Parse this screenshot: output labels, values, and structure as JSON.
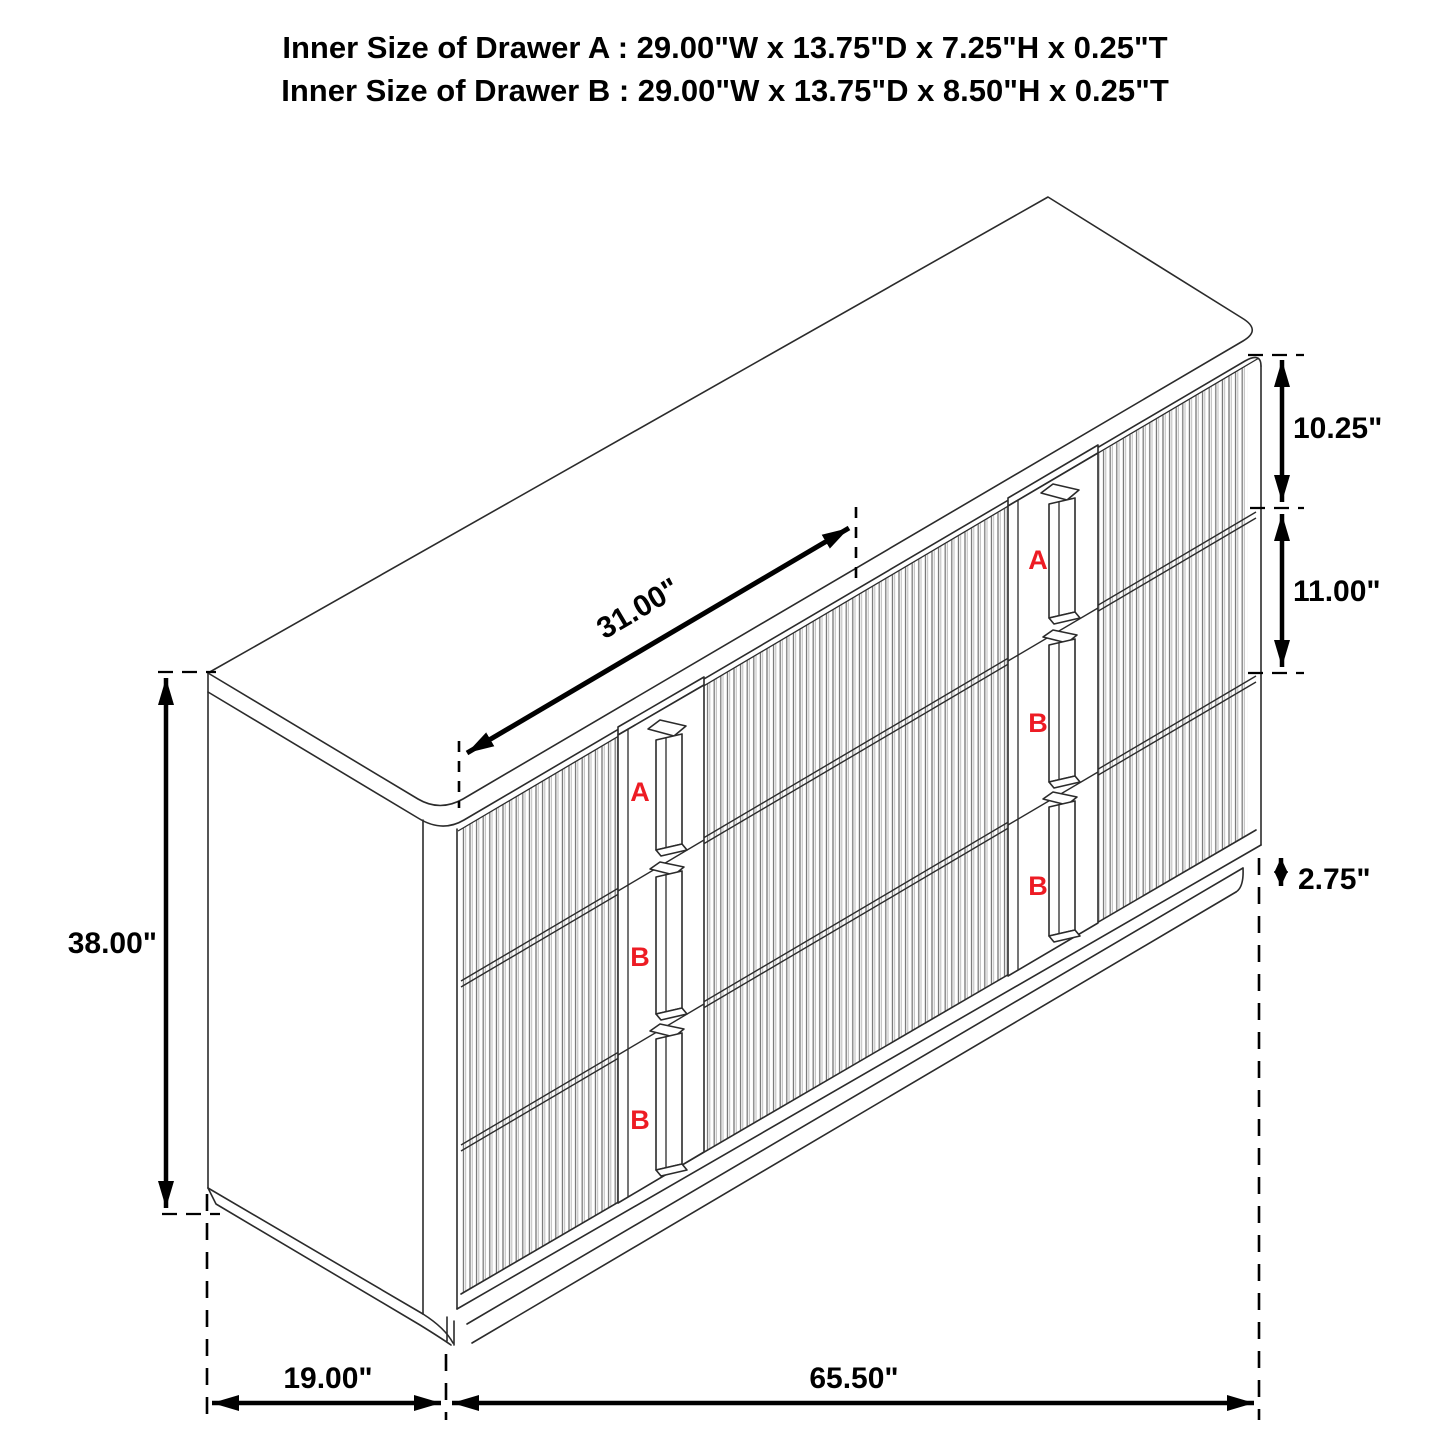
{
  "title": {
    "line1": "Inner Size of Drawer A : 29.00\"W x 13.75\"D x 7.25\"H x 0.25\"T",
    "line2": "Inner Size of Drawer B : 29.00\"W x 13.75\"D x 8.50\"H x 0.25\"T"
  },
  "dimensions": {
    "drawer_a_front_height": "10.25\"",
    "drawer_b_front_height": "11.00\"",
    "base_height": "2.75\"",
    "overall_height": "38.00\"",
    "drawer_front_width": "31.00\"",
    "overall_depth": "19.00\"",
    "overall_width": "65.50\""
  },
  "drawer_labels": {
    "left_column": [
      "A",
      "B",
      "B"
    ],
    "right_column": [
      "A",
      "B",
      "B"
    ]
  },
  "colors": {
    "drawer_label_red": "#ed1c24",
    "line_color": "#000000"
  }
}
